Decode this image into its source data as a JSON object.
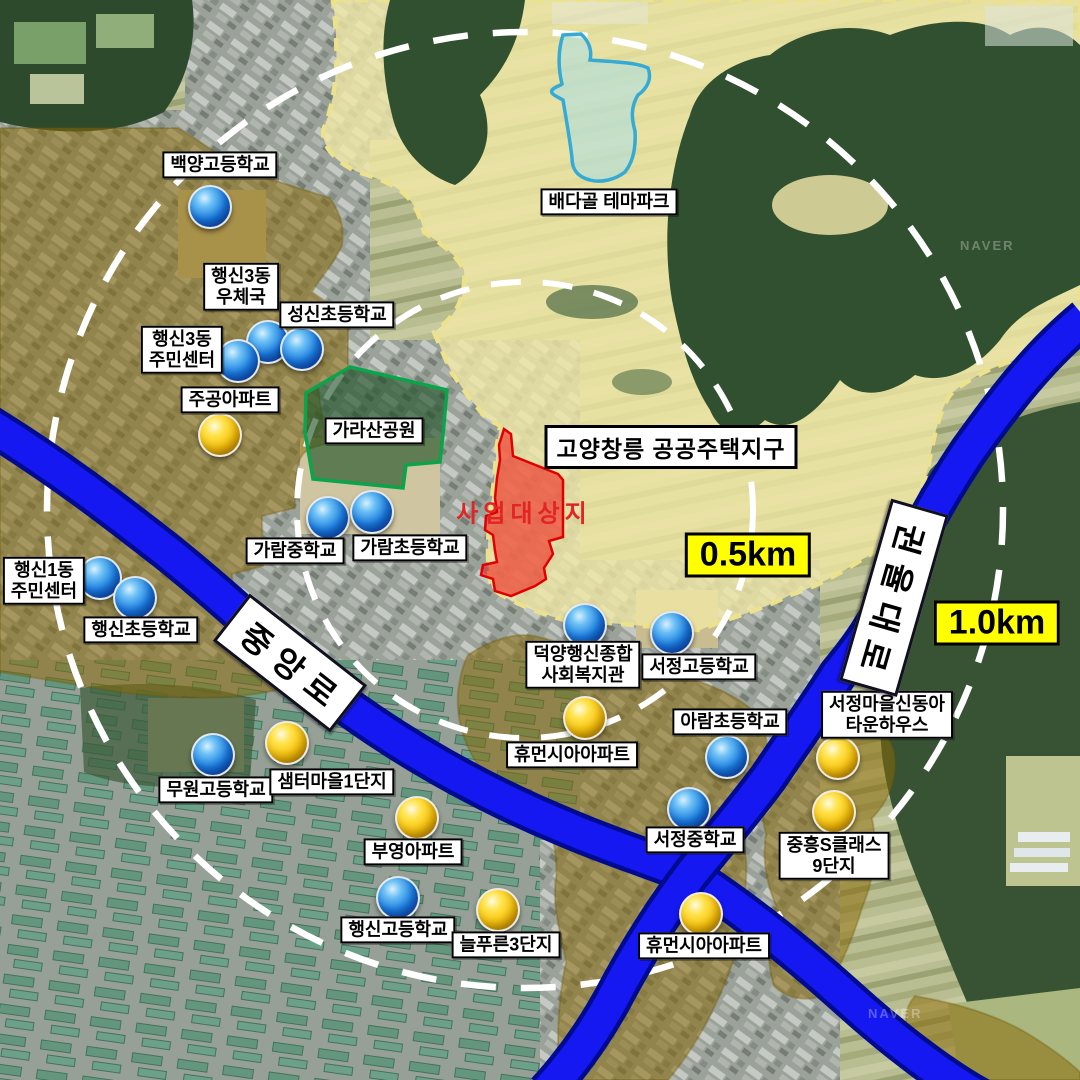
{
  "map": {
    "district_label": {
      "text": "고양창릉 공공주택지구",
      "x": 671,
      "y": 447
    },
    "site_label": {
      "text": "사업대상지",
      "x": 524,
      "y": 511
    },
    "radius_labels": [
      {
        "text": "0.5km",
        "x": 748,
        "y": 555
      },
      {
        "text": "1.0km",
        "x": 997,
        "y": 623
      }
    ],
    "road_labels": [
      {
        "text": "중앙로",
        "x": 290,
        "y": 663,
        "angle": 38
      },
      {
        "text": "권율대로",
        "x": 894,
        "y": 598,
        "angle": 106
      }
    ],
    "area_labels": [
      {
        "text": "배다골 테마파크",
        "x": 609,
        "y": 202
      },
      {
        "text": "가라산공원",
        "x": 374,
        "y": 431
      }
    ],
    "watermarks": [
      {
        "text": "NAVER",
        "x": 960,
        "y": 238
      },
      {
        "text": "NAVER",
        "x": 868,
        "y": 1006
      }
    ],
    "pois": [
      {
        "name": "백양고등학교",
        "lines": [
          "백양고등학교"
        ],
        "marker": "blue",
        "mx": 210,
        "my": 207,
        "lx": 220,
        "ly": 165
      },
      {
        "name": "행신3동 우체국",
        "lines": [
          "행신3동",
          "우체국"
        ],
        "marker": "blue",
        "mx": 268,
        "my": 342,
        "lx": 241,
        "ly": 287
      },
      {
        "name": "성신초등학교",
        "lines": [
          "성신초등학교"
        ],
        "marker": "blue",
        "mx": 302,
        "my": 349,
        "lx": 337,
        "ly": 315
      },
      {
        "name": "행신3동 주민센터",
        "lines": [
          "행신3동",
          "주민센터"
        ],
        "marker": "blue",
        "mx": 238,
        "my": 361,
        "lx": 182,
        "ly": 350
      },
      {
        "name": "주공아파트",
        "lines": [
          "주공아파트"
        ],
        "marker": "yellow",
        "mx": 220,
        "my": 435,
        "lx": 230,
        "ly": 400
      },
      {
        "name": "가람중학교",
        "lines": [
          "가람중학교"
        ],
        "marker": "blue",
        "mx": 328,
        "my": 518,
        "lx": 295,
        "ly": 551
      },
      {
        "name": "가람초등학교",
        "lines": [
          "가람초등학교"
        ],
        "marker": "blue",
        "mx": 372,
        "my": 512,
        "lx": 410,
        "ly": 548
      },
      {
        "name": "행신1동 주민센터",
        "lines": [
          "행신1동",
          "주민센터"
        ],
        "marker": "blue",
        "mx": 100,
        "my": 578,
        "lx": 44,
        "ly": 581
      },
      {
        "name": "행신초등학교",
        "lines": [
          "행신초등학교"
        ],
        "marker": "blue",
        "mx": 135,
        "my": 598,
        "lx": 141,
        "ly": 630
      },
      {
        "name": "무원고등학교",
        "lines": [
          "무원고등학교"
        ],
        "marker": "blue",
        "mx": 213,
        "my": 755,
        "lx": 216,
        "ly": 790
      },
      {
        "name": "샘터마을1단지",
        "lines": [
          "샘터마을1단지"
        ],
        "marker": "yellow",
        "mx": 287,
        "my": 743,
        "lx": 332,
        "ly": 782
      },
      {
        "name": "부영아파트",
        "lines": [
          "부영아파트"
        ],
        "marker": "yellow",
        "mx": 417,
        "my": 818,
        "lx": 413,
        "ly": 852
      },
      {
        "name": "행신고등학교",
        "lines": [
          "행신고등학교"
        ],
        "marker": "blue",
        "mx": 398,
        "my": 898,
        "lx": 398,
        "ly": 930
      },
      {
        "name": "늘푸른3단지",
        "lines": [
          "늘푸른3단지"
        ],
        "marker": "yellow",
        "mx": 498,
        "my": 910,
        "lx": 506,
        "ly": 945
      },
      {
        "name": "덕양행신종합 사회복지관",
        "lines": [
          "덕양행신종합",
          "사회복지관"
        ],
        "marker": "blue",
        "mx": 585,
        "my": 625,
        "lx": 583,
        "ly": 665
      },
      {
        "name": "서정고등학교",
        "lines": [
          "서정고등학교"
        ],
        "marker": "blue",
        "mx": 672,
        "my": 633,
        "lx": 699,
        "ly": 667
      },
      {
        "name": "휴먼시아아파트",
        "lines": [
          "휴먼시아아파트"
        ],
        "marker": "yellow",
        "mx": 585,
        "my": 718,
        "lx": 572,
        "ly": 755
      },
      {
        "name": "아람초등학교",
        "lines": [
          "아람초등학교"
        ],
        "marker": "blue",
        "mx": 727,
        "my": 757,
        "lx": 730,
        "ly": 722
      },
      {
        "name": "서정마을신동아 타운하우스",
        "lines": [
          "서정마을신동아",
          "타운하우스"
        ],
        "marker": "yellow",
        "mx": 838,
        "my": 758,
        "lx": 887,
        "ly": 715
      },
      {
        "name": "서정중학교",
        "lines": [
          "서정중학교"
        ],
        "marker": "blue",
        "mx": 689,
        "my": 809,
        "lx": 695,
        "ly": 840
      },
      {
        "name": "중흥S클래스 9단지",
        "lines": [
          "중흥S클래스",
          "9단지"
        ],
        "marker": "yellow",
        "mx": 834,
        "my": 812,
        "lx": 834,
        "ly": 856
      },
      {
        "name": "휴먼시아아파트",
        "lines": [
          "휴먼시아아파트"
        ],
        "marker": "yellow",
        "mx": 701,
        "my": 914,
        "lx": 704,
        "ly": 946
      }
    ],
    "colors": {
      "road_blue": "#1518f0",
      "road_edge": "#000b8f",
      "district_fill": "#f2e9a5",
      "district_dash": "#ece28e",
      "residential_olive": "#8a6a06",
      "site_red": "#e01010",
      "park_green": "#0aa44a",
      "themepark_cyan": "#35aad5",
      "radius_circle": "#ffffff",
      "marker_blue": "#1a7ce0",
      "marker_yellow": "#f7bd00",
      "km_box": "#ffff00"
    }
  }
}
